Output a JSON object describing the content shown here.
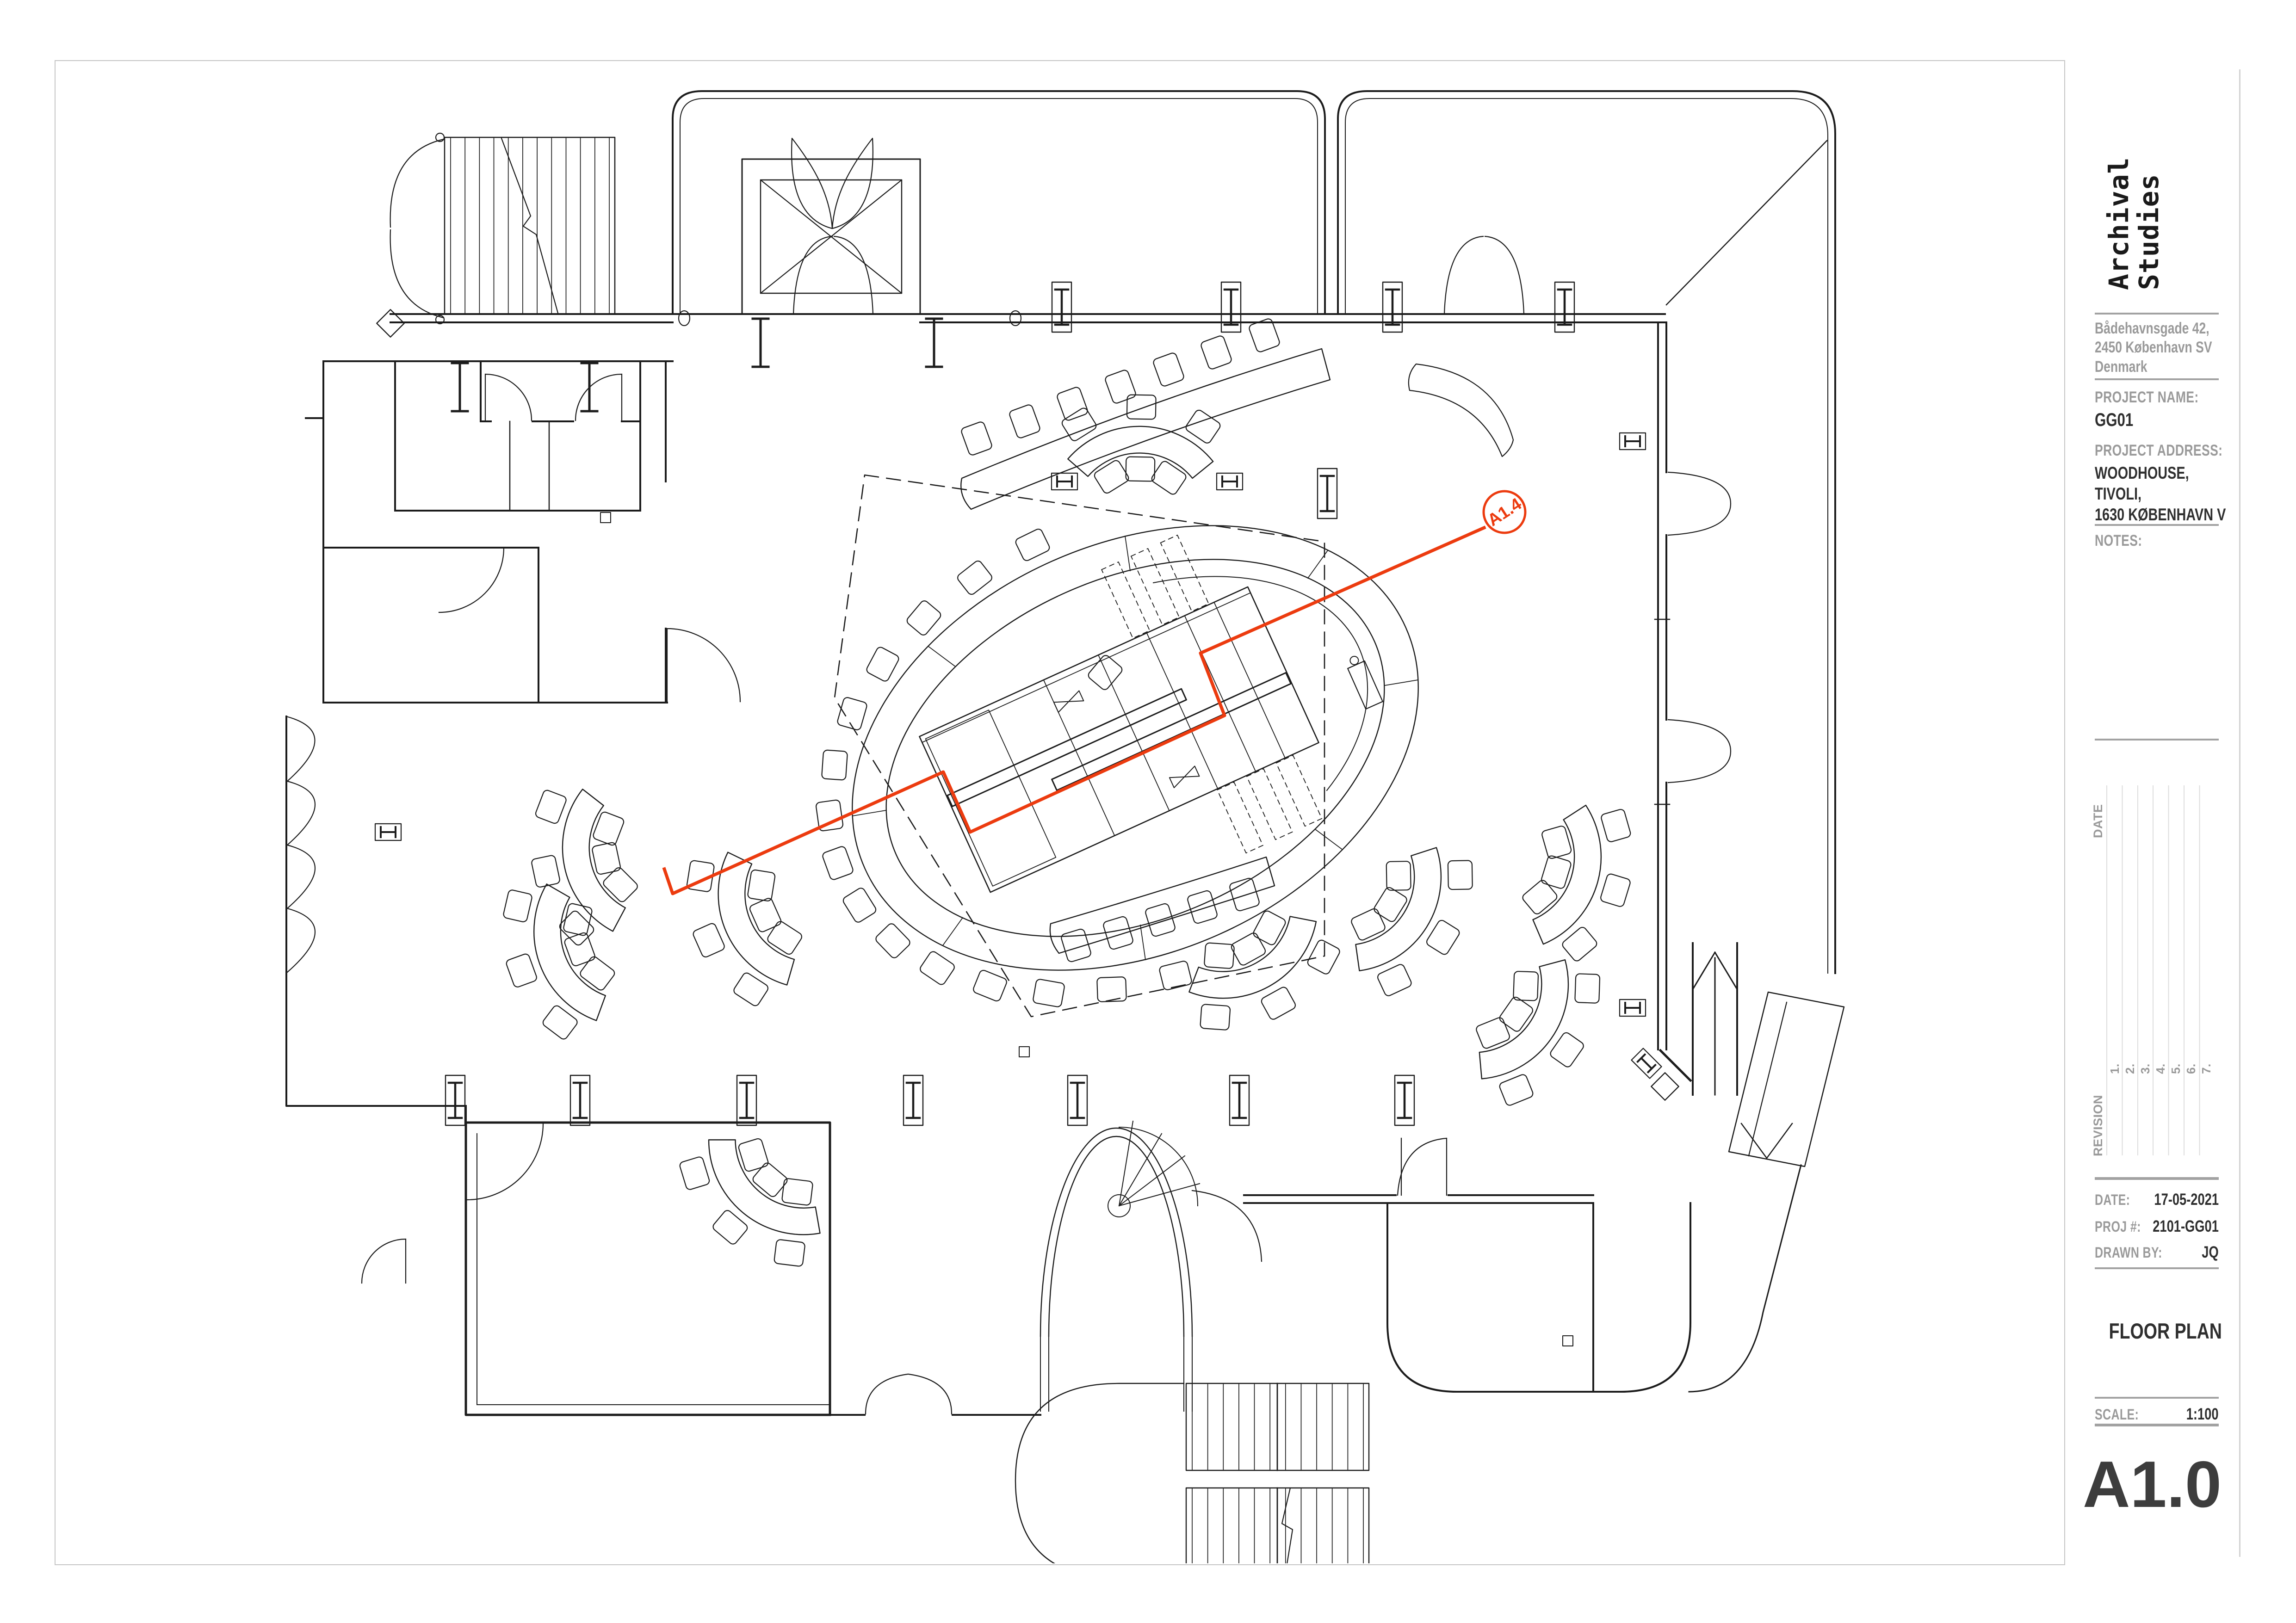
{
  "title_block": {
    "logo_line1": "Archival",
    "logo_line2": "Studies",
    "address_lines": [
      "Bådehavnsgade 42,",
      "2450 København SV",
      "Denmark"
    ],
    "project_name_label": "PROJECT NAME:",
    "project_name": "GG01",
    "project_address_label": "PROJECT ADDRESS:",
    "project_address_lines": [
      "WOODHOUSE,",
      "TIVOLI,",
      "1630 KØBENHAVN V"
    ],
    "notes_label": "NOTES:",
    "revision": {
      "date_label": "DATE",
      "revision_label": "REVISION",
      "rows": [
        "1.",
        "2.",
        "3.",
        "4.",
        "5.",
        "6.",
        "7."
      ]
    },
    "date_label": "DATE:",
    "date_value": "17-05-2021",
    "proj_label": "PROJ #:",
    "proj_value": "2101-GG01",
    "drawn_label": "DRAWN BY:",
    "drawn_value": "JQ",
    "sheet_title": "FLOOR PLAN",
    "scale_label": "SCALE:",
    "scale_value": "1:100",
    "sheet_number": "A1.0"
  },
  "plan": {
    "section_marker": "A1.4"
  },
  "colors": {
    "accent": "#EC3B0F",
    "label_gray": "#9A9A9A",
    "ink": "#1C1C1C"
  }
}
